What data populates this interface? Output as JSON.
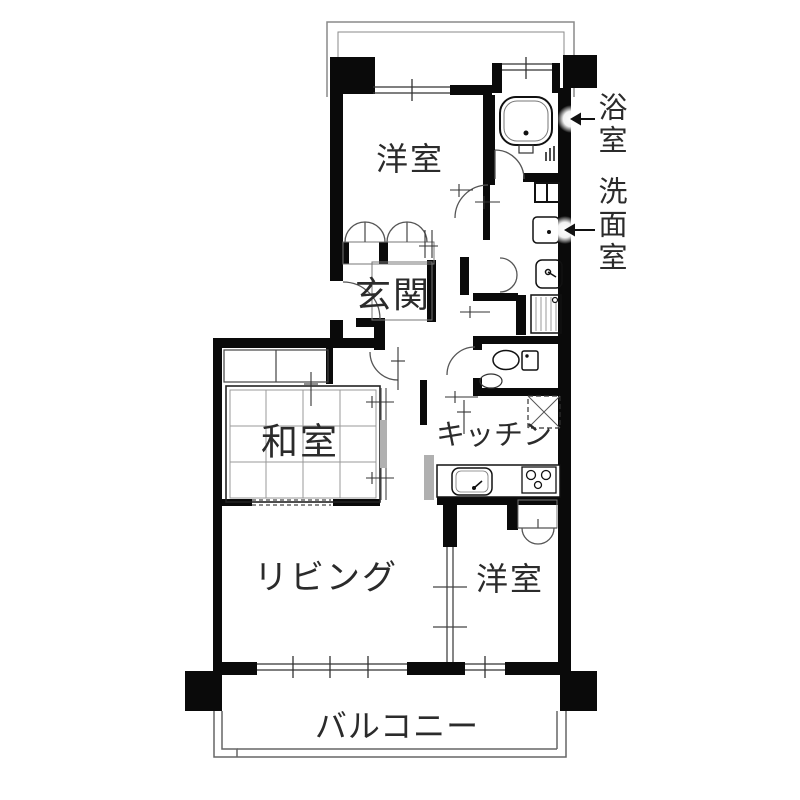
{
  "title": "マンション間取り図",
  "rooms": {
    "yoshitsu_top": "洋室",
    "genkan": "玄関",
    "washitsu": "和室",
    "kitchen": "キッチン",
    "living": "リビング",
    "yoshitsu_bottom": "洋室",
    "balcony": "バルコニー"
  },
  "callouts": {
    "bathroom": "浴室",
    "washroom": "洗面室"
  },
  "icons": {
    "bathtub": "bathtub-icon",
    "toilet": "toilet-icon",
    "kitchen_sink": "kitchen-sink-icon",
    "stove": "stove-icon",
    "washing_machine": "washing-machine-icon",
    "wash_basin": "wash-basin-icon",
    "refrigerator": "refrigerator-icon",
    "arrow_left": "left-arrow-icon"
  },
  "colors": {
    "wall": "#0a0a0a",
    "thin_line": "#555555",
    "grid_line": "#999999",
    "hatch_fill": "#b0b0b0",
    "text": "#2b2b2b",
    "background": "#ffffff"
  }
}
